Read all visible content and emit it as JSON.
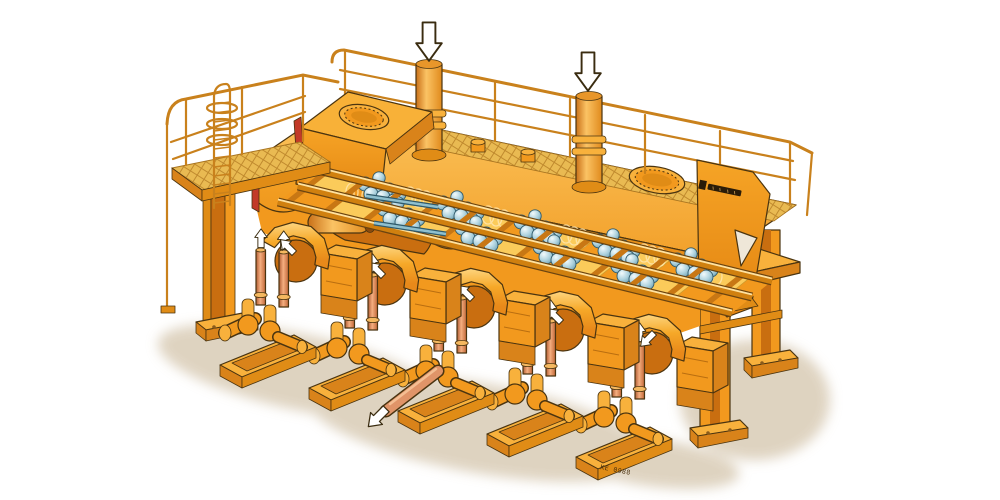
{
  "figure": {
    "style": "isometric cutaway technical illustration",
    "background_color": "#ffffff",
    "subject": "Large orange industrial multi-cylinder pump installation: roof platform with handrails, mesh grating, two manhole covers and two accumulator cylinders; cutaway flank showing hydraulic rams and banks of spring-loaded ball valves on an inclined rail bed; five skid-mounted pump units in front with copper riser pipes and flow arrows; right support table on two legs"
  },
  "palette": {
    "outline": "#4a3410",
    "orange": "#F2991E",
    "orangeDark": "#E08C16",
    "orangeDeep": "#C96E10",
    "orangeLight": "#F8B13C",
    "panelDark": "#D9831A",
    "yellowPanel": "#FBCB5A",
    "meshGold": "#E9BA52",
    "meshLine": "#C08A2E",
    "copper": "#E09468",
    "copperDark": "#B05C32",
    "teal": "#A9CFDC",
    "tealDark": "#5E93A6",
    "tealOutline": "#2F5A6B",
    "redCut": "#C23A28",
    "shadow": "#DBCFBA",
    "arrowFill": "#FFFFFF",
    "rail": "#C9811C"
  },
  "labels": {
    "base_plate_code": "KE 0988",
    "manufacturer_logo": "illegible dark wordmark"
  },
  "components": {
    "roof": {
      "manhole_covers": 2,
      "accumulator_cylinders": 2,
      "handrail_sections": 2,
      "grating": "diamond mesh",
      "small_stub_fittings": 2
    },
    "left_access": {
      "service_platform": true,
      "caged_ladder": true,
      "support_column": true
    },
    "cutaway": {
      "hydraulic_rams": 2,
      "piston_rods": 2,
      "red_cut_edges": 2,
      "interior_arch": 1
    },
    "valve_bed": {
      "rails": 3,
      "ball_valve_clusters": 9,
      "spring_coils": 6,
      "yellow_panels": 11
    },
    "pump_units": [
      {
        "id": 1,
        "riser_pipes": 2,
        "riser_arrows": true,
        "hood_arrow": "up-left",
        "discharge_pipe": null
      },
      {
        "id": 2,
        "riser_pipes": 2,
        "riser_arrows": true,
        "hood_arrow": "up-left",
        "discharge_pipe": null
      },
      {
        "id": 3,
        "riser_pipes": 2,
        "riser_arrows": false,
        "hood_arrow": "up-left",
        "discharge_pipe": "diagonal pipe to lower-left with hollow arrow"
      },
      {
        "id": 4,
        "riser_pipes": 2,
        "riser_arrows": true,
        "hood_arrow": "up-left",
        "discharge_pipe": null
      },
      {
        "id": 5,
        "riser_pipes": 2,
        "riser_arrows": true,
        "hood_arrow": "down-left",
        "discharge_pipe": null
      }
    ],
    "right_support": {
      "legs": 2,
      "base_plates": 2,
      "gusset_plate_with_triangular_cutout": true,
      "cross_brace": 1
    }
  },
  "annotations": {
    "roof_inlet_down_arrows": 2,
    "riser_up_arrows": 8,
    "hood_flow_arrows": 5,
    "discharge_hollow_arrows": 1
  }
}
